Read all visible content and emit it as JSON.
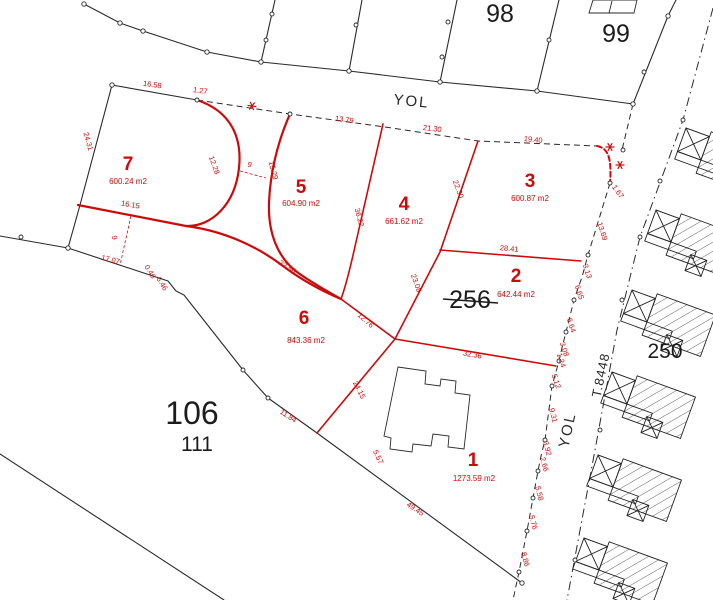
{
  "map_title": "cadastral-parcel-plan",
  "colors": {
    "red": "#cc0a0a",
    "black": "#2a2a2a",
    "background": "#ffffff"
  },
  "blocks": {
    "b98": "98",
    "b99": "99",
    "b106": "106",
    "b111": "111",
    "b256": "256",
    "b250": "250"
  },
  "roads": {
    "yol_top": "YOL",
    "yol_side": "YOL",
    "t8448": "T.8448"
  },
  "parcels": [
    {
      "number": "7",
      "area": "600.24 m2"
    },
    {
      "number": "5",
      "area": "604.90 m2"
    },
    {
      "number": "4",
      "area": "661.62 m2"
    },
    {
      "number": "3",
      "area": "600.87 m2"
    },
    {
      "number": "2",
      "area": "642.44 m2"
    },
    {
      "number": "6",
      "area": "843.36 m2"
    },
    {
      "number": "1",
      "area": "1273.59 m2"
    }
  ],
  "dimensions": [
    {
      "t": "16.58",
      "x": 152,
      "y": 87,
      "r": 8
    },
    {
      "t": "1.27",
      "x": 200,
      "y": 93,
      "r": 8
    },
    {
      "t": "24.31",
      "x": 86,
      "y": 142,
      "r": 74
    },
    {
      "t": "12.28",
      "x": 212,
      "y": 166,
      "r": 70
    },
    {
      "t": "9",
      "x": 249,
      "y": 167,
      "r": 15
    },
    {
      "t": "15.29",
      "x": 271,
      "y": 171,
      "r": 75
    },
    {
      "t": "13.79",
      "x": 344,
      "y": 122,
      "r": 8
    },
    {
      "t": "21.30",
      "x": 432,
      "y": 131,
      "r": 7
    },
    {
      "t": "19.40",
      "x": 533,
      "y": 142,
      "r": 6
    },
    {
      "t": "16.15",
      "x": 130,
      "y": 207,
      "r": 10
    },
    {
      "t": "9",
      "x": 112,
      "y": 238,
      "r": 80
    },
    {
      "t": "17.07",
      "x": 110,
      "y": 262,
      "r": 14
    },
    {
      "t": "0.46",
      "x": 148,
      "y": 273,
      "r": 58
    },
    {
      "t": "6.46",
      "x": 160,
      "y": 285,
      "r": 58
    },
    {
      "t": "22.56",
      "x": 286,
      "y": 269,
      "r": 33
    },
    {
      "t": "36.22",
      "x": 357,
      "y": 218,
      "r": 75
    },
    {
      "t": "22.30",
      "x": 456,
      "y": 190,
      "r": 70
    },
    {
      "t": "23.08",
      "x": 414,
      "y": 284,
      "r": 70
    },
    {
      "t": "28.41",
      "x": 509,
      "y": 251,
      "r": 5
    },
    {
      "t": "12.76",
      "x": 364,
      "y": 322,
      "r": 42
    },
    {
      "t": "24.15",
      "x": 357,
      "y": 391,
      "r": 63
    },
    {
      "t": "11.84",
      "x": 287,
      "y": 418,
      "r": 33
    },
    {
      "t": "32.36",
      "x": 472,
      "y": 357,
      "r": 10
    },
    {
      "t": "5.57",
      "x": 376,
      "y": 458,
      "r": 65
    },
    {
      "t": "49.45",
      "x": 414,
      "y": 511,
      "r": 33
    },
    {
      "t": "1.67",
      "x": 616,
      "y": 193,
      "r": 55
    },
    {
      "t": "13.69",
      "x": 600,
      "y": 232,
      "r": 72
    },
    {
      "t": "3.13",
      "x": 585,
      "y": 272,
      "r": 72
    },
    {
      "t": "6.65",
      "x": 577,
      "y": 293,
      "r": 72
    },
    {
      "t": "6.64",
      "x": 569,
      "y": 326,
      "r": 72
    },
    {
      "t": "3.08",
      "x": 562,
      "y": 350,
      "r": 72
    },
    {
      "t": "1.24",
      "x": 559,
      "y": 361,
      "r": 72
    },
    {
      "t": "5.12",
      "x": 554,
      "y": 382,
      "r": 72
    },
    {
      "t": "9.31",
      "x": 551,
      "y": 416,
      "r": 75
    },
    {
      "t": "3.92",
      "x": 545,
      "y": 449,
      "r": 75
    },
    {
      "t": "2.66",
      "x": 542,
      "y": 465,
      "r": 75
    },
    {
      "t": "5.58",
      "x": 537,
      "y": 494,
      "r": 75
    },
    {
      "t": "5.76",
      "x": 531,
      "y": 523,
      "r": 75
    },
    {
      "t": "8.86",
      "x": 523,
      "y": 560,
      "r": 75
    }
  ]
}
